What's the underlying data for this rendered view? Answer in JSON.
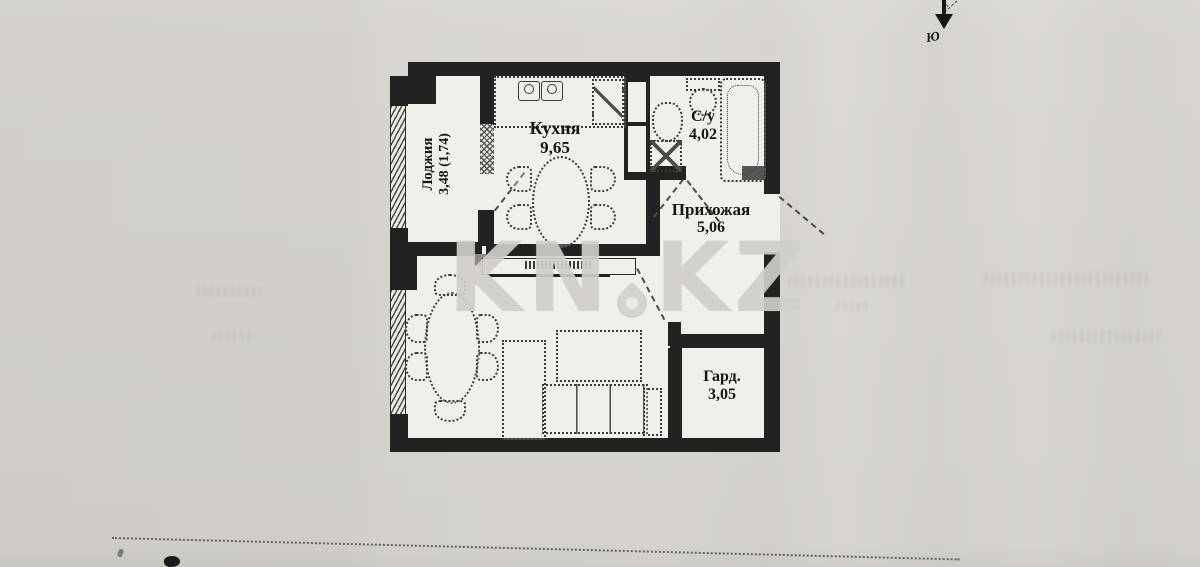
{
  "rooms": [
    {
      "name": "Лоджия",
      "area": "3,48 (1,74)"
    },
    {
      "name": "Кухня",
      "area": "9,65"
    },
    {
      "name": "С/у",
      "area": "4,02"
    },
    {
      "name": "Прихожая",
      "area": "5,06"
    },
    {
      "name": "Гард.",
      "area": "3,05"
    }
  ],
  "watermark": {
    "left": "KN",
    "right": "KZ"
  },
  "compass": {
    "south": "Ю"
  },
  "colors": {
    "paper": "#d7d4cf",
    "ink": "#232220",
    "plan_fill": "#f1efea",
    "watermark": "#d1cec9"
  }
}
